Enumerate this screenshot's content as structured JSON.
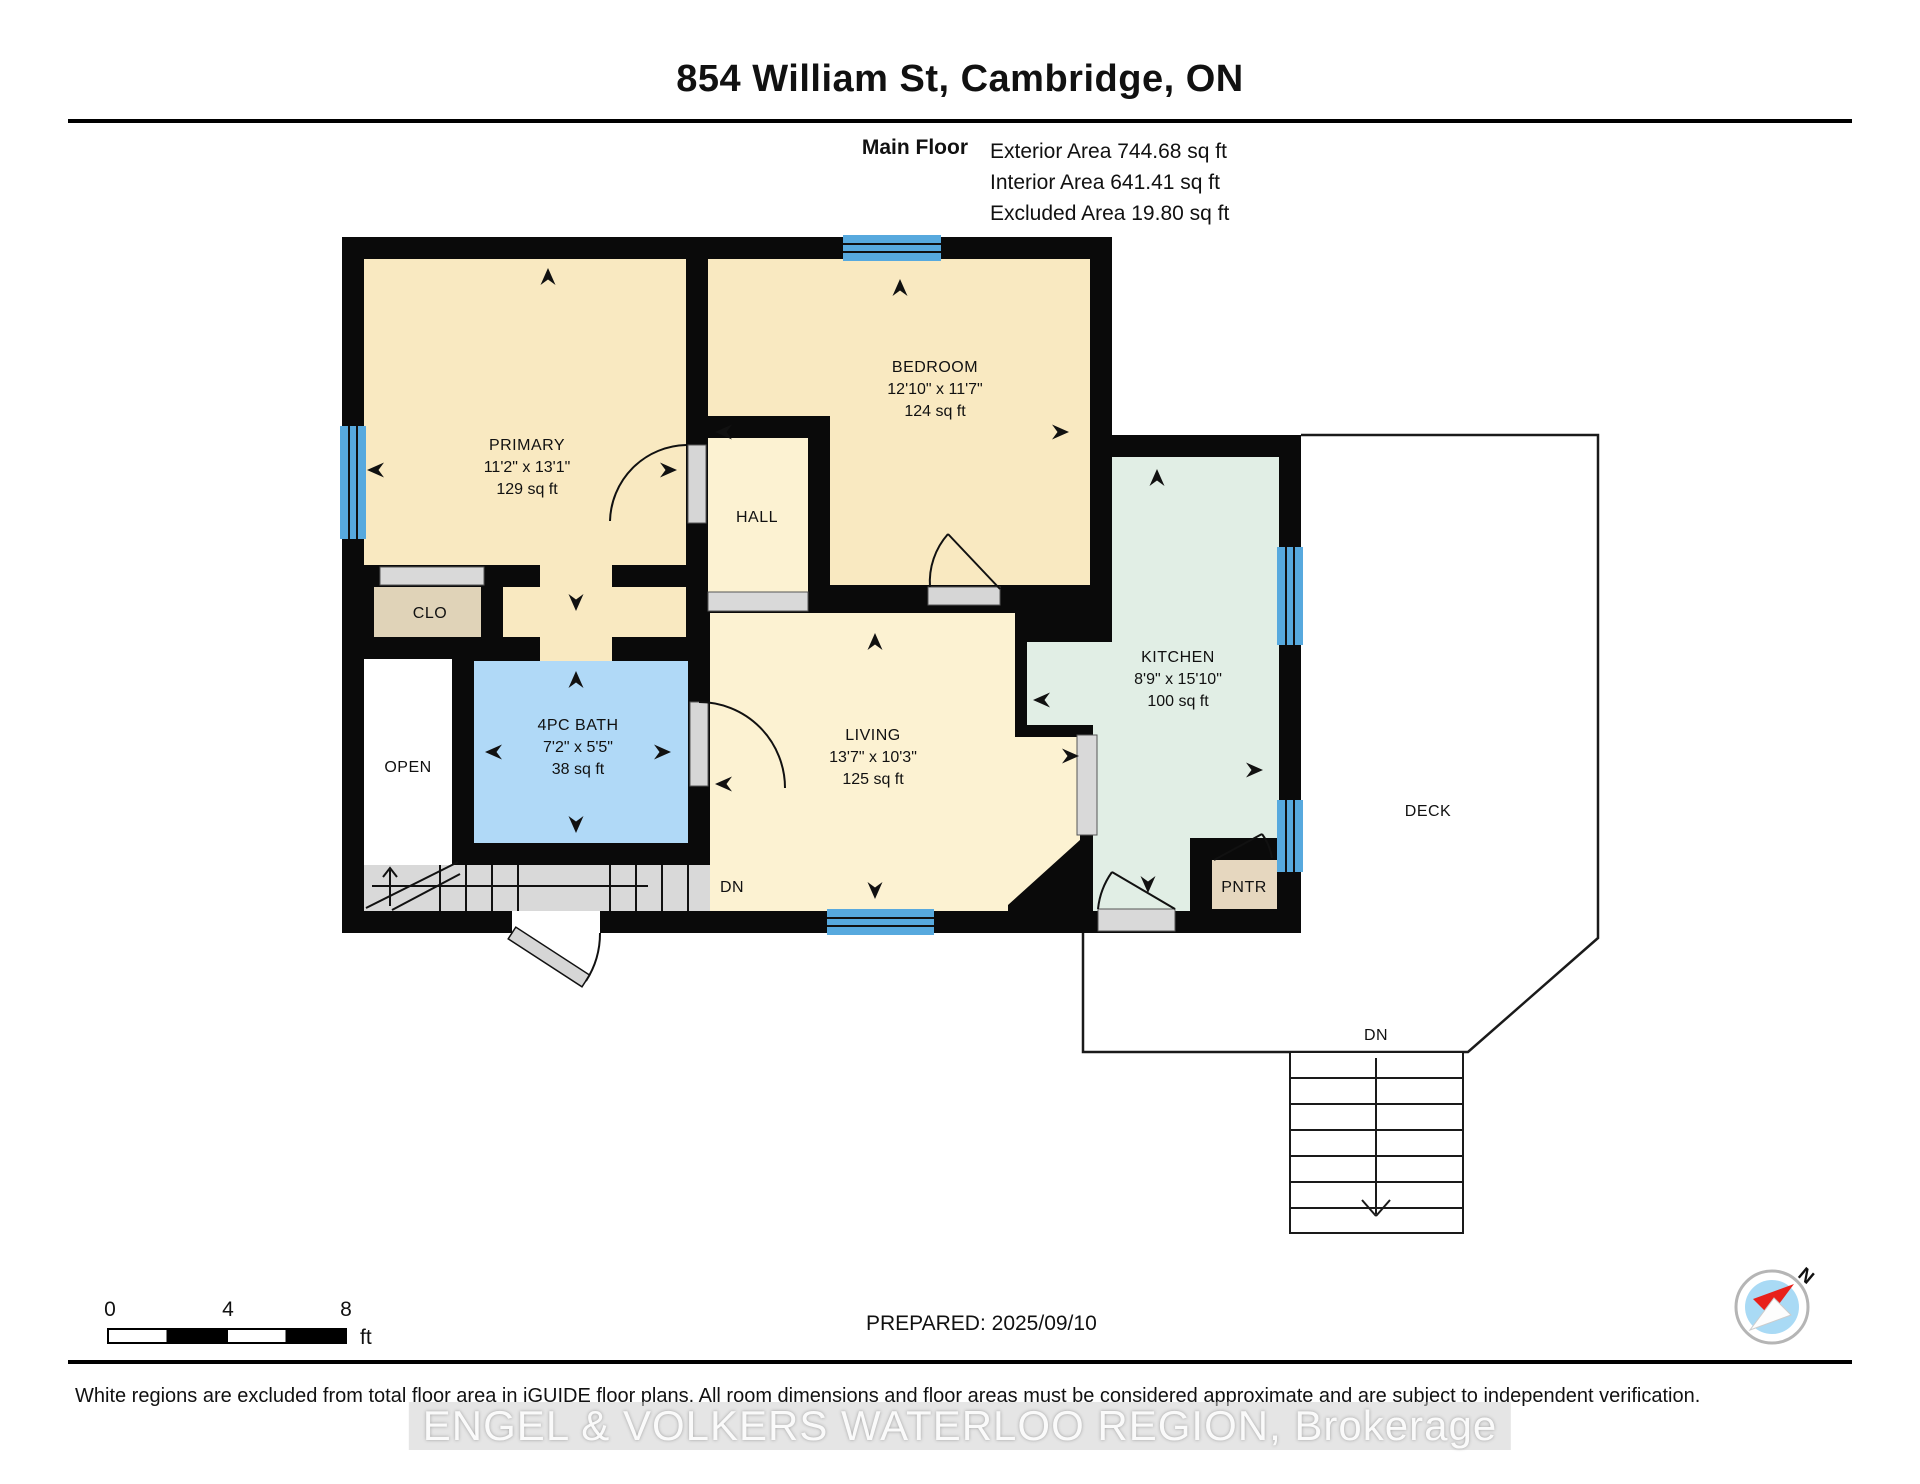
{
  "header": {
    "title": "854 William St, Cambridge, ON",
    "floor_label": "Main Floor",
    "stats": [
      "Exterior Area 744.68 sq ft",
      "Interior Area 641.41 sq ft",
      "Excluded Area 19.80 sq ft"
    ]
  },
  "rooms": {
    "primary": {
      "name": "PRIMARY",
      "dims": "11'2\" x 13'1\"",
      "area": "129 sq ft"
    },
    "bedroom": {
      "name": "BEDROOM",
      "dims": "12'10\" x 11'7\"",
      "area": "124 sq ft"
    },
    "hall": {
      "name": "HALL"
    },
    "clo": {
      "name": "CLO"
    },
    "open": {
      "name": "OPEN"
    },
    "bath": {
      "name": "4PC BATH",
      "dims": "7'2\" x 5'5\"",
      "area": "38 sq ft"
    },
    "living": {
      "name": "LIVING",
      "dims": "13'7\" x 10'3\"",
      "area": "125 sq ft"
    },
    "kitchen": {
      "name": "KITCHEN",
      "dims": "8'9\" x 15'10\"",
      "area": "100 sq ft"
    },
    "pntr": {
      "name": "PNTR"
    },
    "deck": {
      "name": "DECK"
    }
  },
  "labels": {
    "dn_interior": "DN",
    "dn_deck": "DN"
  },
  "scale_bar": {
    "t0": "0",
    "t4": "4",
    "t8": "8",
    "unit": "ft"
  },
  "prepared": "PREPARED: 2025/09/10",
  "compass": {
    "north_label": "N"
  },
  "footer": {
    "disclaimer": "White regions are excluded from total floor area in iGUIDE floor plans. All room dimensions and floor areas must be considered approximate and are subject to independent verification.",
    "watermark": "ENGEL & VOLKERS WATERLOO REGION, Brokerage"
  },
  "colors": {
    "wall": "#0a0a0a",
    "room_beige": "#f9e9c1",
    "room_beige_light": "#fcf2d2",
    "bath_blue": "#b0d9f7",
    "kitchen_green": "#e1eee5",
    "closet_tan": "#e0d3b8",
    "pantry_tan": "#e6d7bf",
    "window_blue": "#57a9de",
    "stair_gray": "#d9d9d9",
    "compass_blue": "#a9daf5",
    "compass_red": "#e8201a"
  }
}
